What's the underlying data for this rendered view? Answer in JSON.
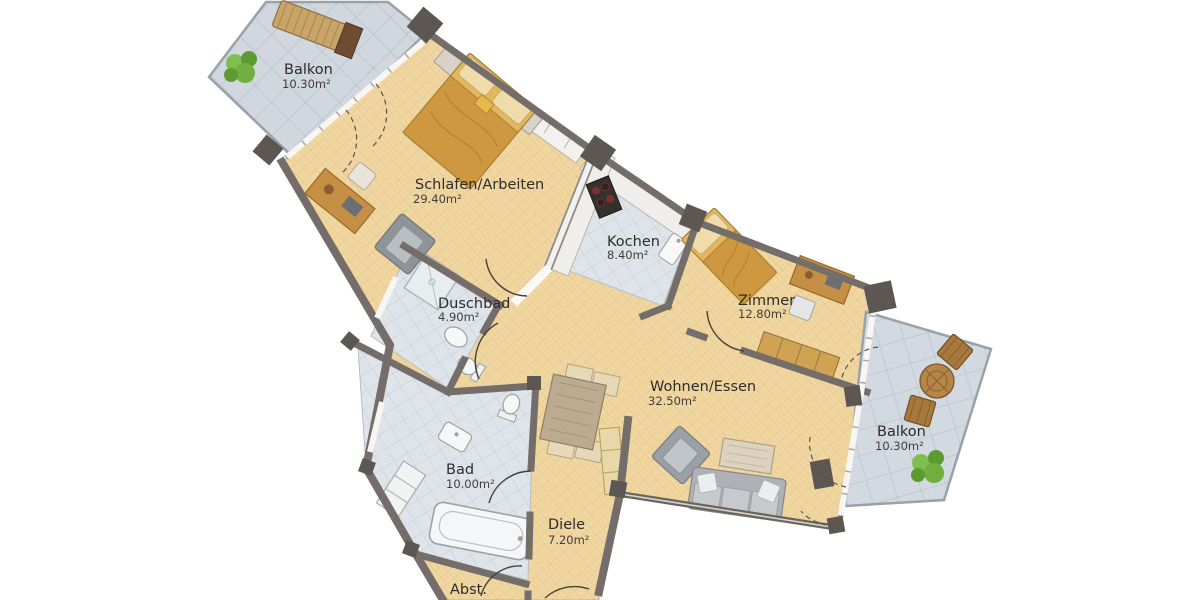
{
  "floorplan": {
    "type": "apartment-floor-plan",
    "rooms": [
      {
        "id": "balkon-top-left",
        "name": "Balkon",
        "area": "10.30m²"
      },
      {
        "id": "schlafen-arbeiten",
        "name": "Schlafen/Arbeiten",
        "area": "29.40m²"
      },
      {
        "id": "kochen",
        "name": "Kochen",
        "area": "8.40m²"
      },
      {
        "id": "zimmer",
        "name": "Zimmer",
        "area": "12.80m²"
      },
      {
        "id": "duschbad",
        "name": "Duschbad",
        "area": "4.90m²"
      },
      {
        "id": "wohnen-essen",
        "name": "Wohnen/Essen",
        "area": "32.50m²"
      },
      {
        "id": "balkon-right",
        "name": "Balkon",
        "area": "10.30m²"
      },
      {
        "id": "bad",
        "name": "Bad",
        "area": "10.00m²"
      },
      {
        "id": "diele",
        "name": "Diele",
        "area": "7.20m²"
      },
      {
        "id": "abstellraum",
        "name": "Abst.",
        "area": ""
      }
    ],
    "palette": {
      "background": "#ffffff",
      "parquet_floor": "#f0d7a1",
      "bath_tile": "#dee4e9",
      "balcony_tile": "#d0d7de",
      "wall": "#746d69",
      "wall_dark": "#5d5753",
      "window_band": "#f7f6f3",
      "furniture_wood": "#dcae55",
      "furniture_gray": "#aeb2b6",
      "fixture_white": "#f5f7f7",
      "plant_green": "#6fae3f",
      "label_text": "#2d2c2a"
    }
  }
}
